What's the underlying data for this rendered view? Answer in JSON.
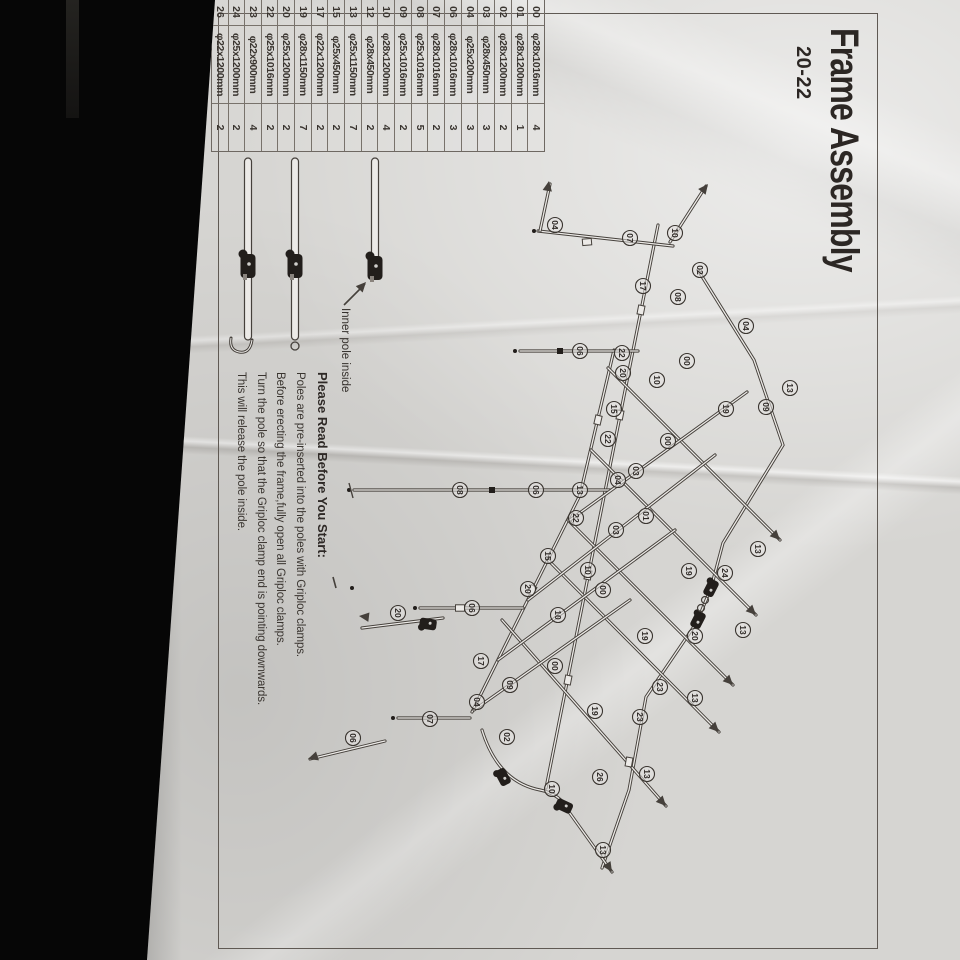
{
  "title": {
    "main": "Frame Assembly",
    "model": "20-22"
  },
  "parts_table": {
    "rows": [
      {
        "id": "00",
        "dim": "φ28x1016mm",
        "qty": "4"
      },
      {
        "id": "01",
        "dim": "φ28x1200mm",
        "qty": "1"
      },
      {
        "id": "02",
        "dim": "φ28x1200mm",
        "qty": "2"
      },
      {
        "id": "03",
        "dim": "φ28x450mm",
        "qty": "3"
      },
      {
        "id": "04",
        "dim": "φ25x200mm",
        "qty": "3"
      },
      {
        "id": "06",
        "dim": "φ28x1016mm",
        "qty": "3"
      },
      {
        "id": "07",
        "dim": "φ28x1016mm",
        "qty": "2"
      },
      {
        "id": "08",
        "dim": "φ25x1016mm",
        "qty": "5"
      },
      {
        "id": "09",
        "dim": "φ25x1016mm",
        "qty": "2"
      },
      {
        "id": "10",
        "dim": "φ28x1200mm",
        "qty": "4"
      },
      {
        "id": "12",
        "dim": "φ28x450mm",
        "qty": "2"
      },
      {
        "id": "13",
        "dim": "φ25x1150mm",
        "qty": "7"
      },
      {
        "id": "15",
        "dim": "φ25x450mm",
        "qty": "2"
      },
      {
        "id": "17",
        "dim": "φ22x1200mm",
        "qty": "2"
      },
      {
        "id": "19",
        "dim": "φ28x1150mm",
        "qty": "7"
      },
      {
        "id": "20",
        "dim": "φ25x1200mm",
        "qty": "2"
      },
      {
        "id": "22",
        "dim": "φ25x1016mm",
        "qty": "2"
      },
      {
        "id": "23",
        "dim": "φ22x900mm",
        "qty": "4"
      },
      {
        "id": "24",
        "dim": "φ25x1200mm",
        "qty": "2"
      },
      {
        "id": "26",
        "dim": "φ22x1200mm",
        "qty": "2"
      }
    ]
  },
  "legend": {
    "label": "Inner pole inside",
    "icons": [
      "pole-with-griploc-clamp",
      "pole-with-griploc-clamp-ring",
      "pole-with-griploc-clamp-hook"
    ]
  },
  "instructions": {
    "heading": "Please Read Before You Start:",
    "lines": [
      "Poles are pre-inserted into the poles with Griploc clamps.",
      "Before erecting the frame,fully open all Griploc clamps.",
      "Turn the pole so that the Griploc clamp end is pointing downwards.",
      "This will release the pole inside."
    ]
  },
  "diagram": {
    "labels": [
      {
        "n": "04",
        "u": 225,
        "v": 405
      },
      {
        "n": "07",
        "u": 238,
        "v": 330
      },
      {
        "n": "10",
        "u": 233,
        "v": 285
      },
      {
        "n": "02",
        "u": 270,
        "v": 260
      },
      {
        "n": "17",
        "u": 286,
        "v": 317
      },
      {
        "n": "08",
        "u": 297,
        "v": 282
      },
      {
        "n": "04",
        "u": 326,
        "v": 214
      },
      {
        "n": "00",
        "u": 361,
        "v": 273
      },
      {
        "n": "22",
        "u": 353,
        "v": 338
      },
      {
        "n": "20",
        "u": 373,
        "v": 337
      },
      {
        "n": "06",
        "u": 351,
        "v": 380
      },
      {
        "n": "10",
        "u": 380,
        "v": 303
      },
      {
        "n": "13",
        "u": 388,
        "v": 170
      },
      {
        "n": "09",
        "u": 407,
        "v": 194
      },
      {
        "n": "19",
        "u": 409,
        "v": 234
      },
      {
        "n": "15",
        "u": 409,
        "v": 346
      },
      {
        "n": "22",
        "u": 439,
        "v": 352
      },
      {
        "n": "00",
        "u": 441,
        "v": 292
      },
      {
        "n": "03",
        "u": 471,
        "v": 324
      },
      {
        "n": "04",
        "u": 480,
        "v": 342
      },
      {
        "n": "13",
        "u": 490,
        "v": 380
      },
      {
        "n": "06",
        "u": 490,
        "v": 424
      },
      {
        "n": "08",
        "u": 490,
        "v": 500
      },
      {
        "n": "01",
        "u": 516,
        "v": 314
      },
      {
        "n": "22",
        "u": 518,
        "v": 384
      },
      {
        "n": "03",
        "u": 530,
        "v": 344
      },
      {
        "n": "13",
        "u": 549,
        "v": 202
      },
      {
        "n": "24",
        "u": 573,
        "v": 235
      },
      {
        "n": "19",
        "u": 571,
        "v": 271
      },
      {
        "n": "10",
        "u": 570,
        "v": 372
      },
      {
        "n": "00",
        "u": 590,
        "v": 357
      },
      {
        "n": "15",
        "u": 556,
        "v": 412
      },
      {
        "n": "20",
        "u": 589,
        "v": 432
      },
      {
        "n": "10",
        "u": 615,
        "v": 402
      },
      {
        "n": "13",
        "u": 630,
        "v": 217
      },
      {
        "n": "20",
        "u": 636,
        "v": 265
      },
      {
        "n": "19",
        "u": 636,
        "v": 315
      },
      {
        "n": "13",
        "u": 698,
        "v": 265
      },
      {
        "n": "23",
        "u": 687,
        "v": 300
      },
      {
        "n": "23",
        "u": 717,
        "v": 320
      },
      {
        "n": "19",
        "u": 711,
        "v": 365
      },
      {
        "n": "00",
        "u": 666,
        "v": 405
      },
      {
        "n": "17",
        "u": 661,
        "v": 479
      },
      {
        "n": "09",
        "u": 685,
        "v": 450
      },
      {
        "n": "04",
        "u": 702,
        "v": 483
      },
      {
        "n": "02",
        "u": 737,
        "v": 453
      },
      {
        "n": "07",
        "u": 719,
        "v": 530
      },
      {
        "n": "06",
        "u": 608,
        "v": 488
      },
      {
        "n": "13",
        "u": 774,
        "v": 313
      },
      {
        "n": "26",
        "u": 777,
        "v": 360
      },
      {
        "n": "10",
        "u": 789,
        "v": 408
      },
      {
        "n": "13",
        "u": 850,
        "v": 357
      },
      {
        "n": "06",
        "u": 738,
        "v": 607
      },
      {
        "n": "20",
        "u": 613,
        "v": 562
      }
    ]
  }
}
